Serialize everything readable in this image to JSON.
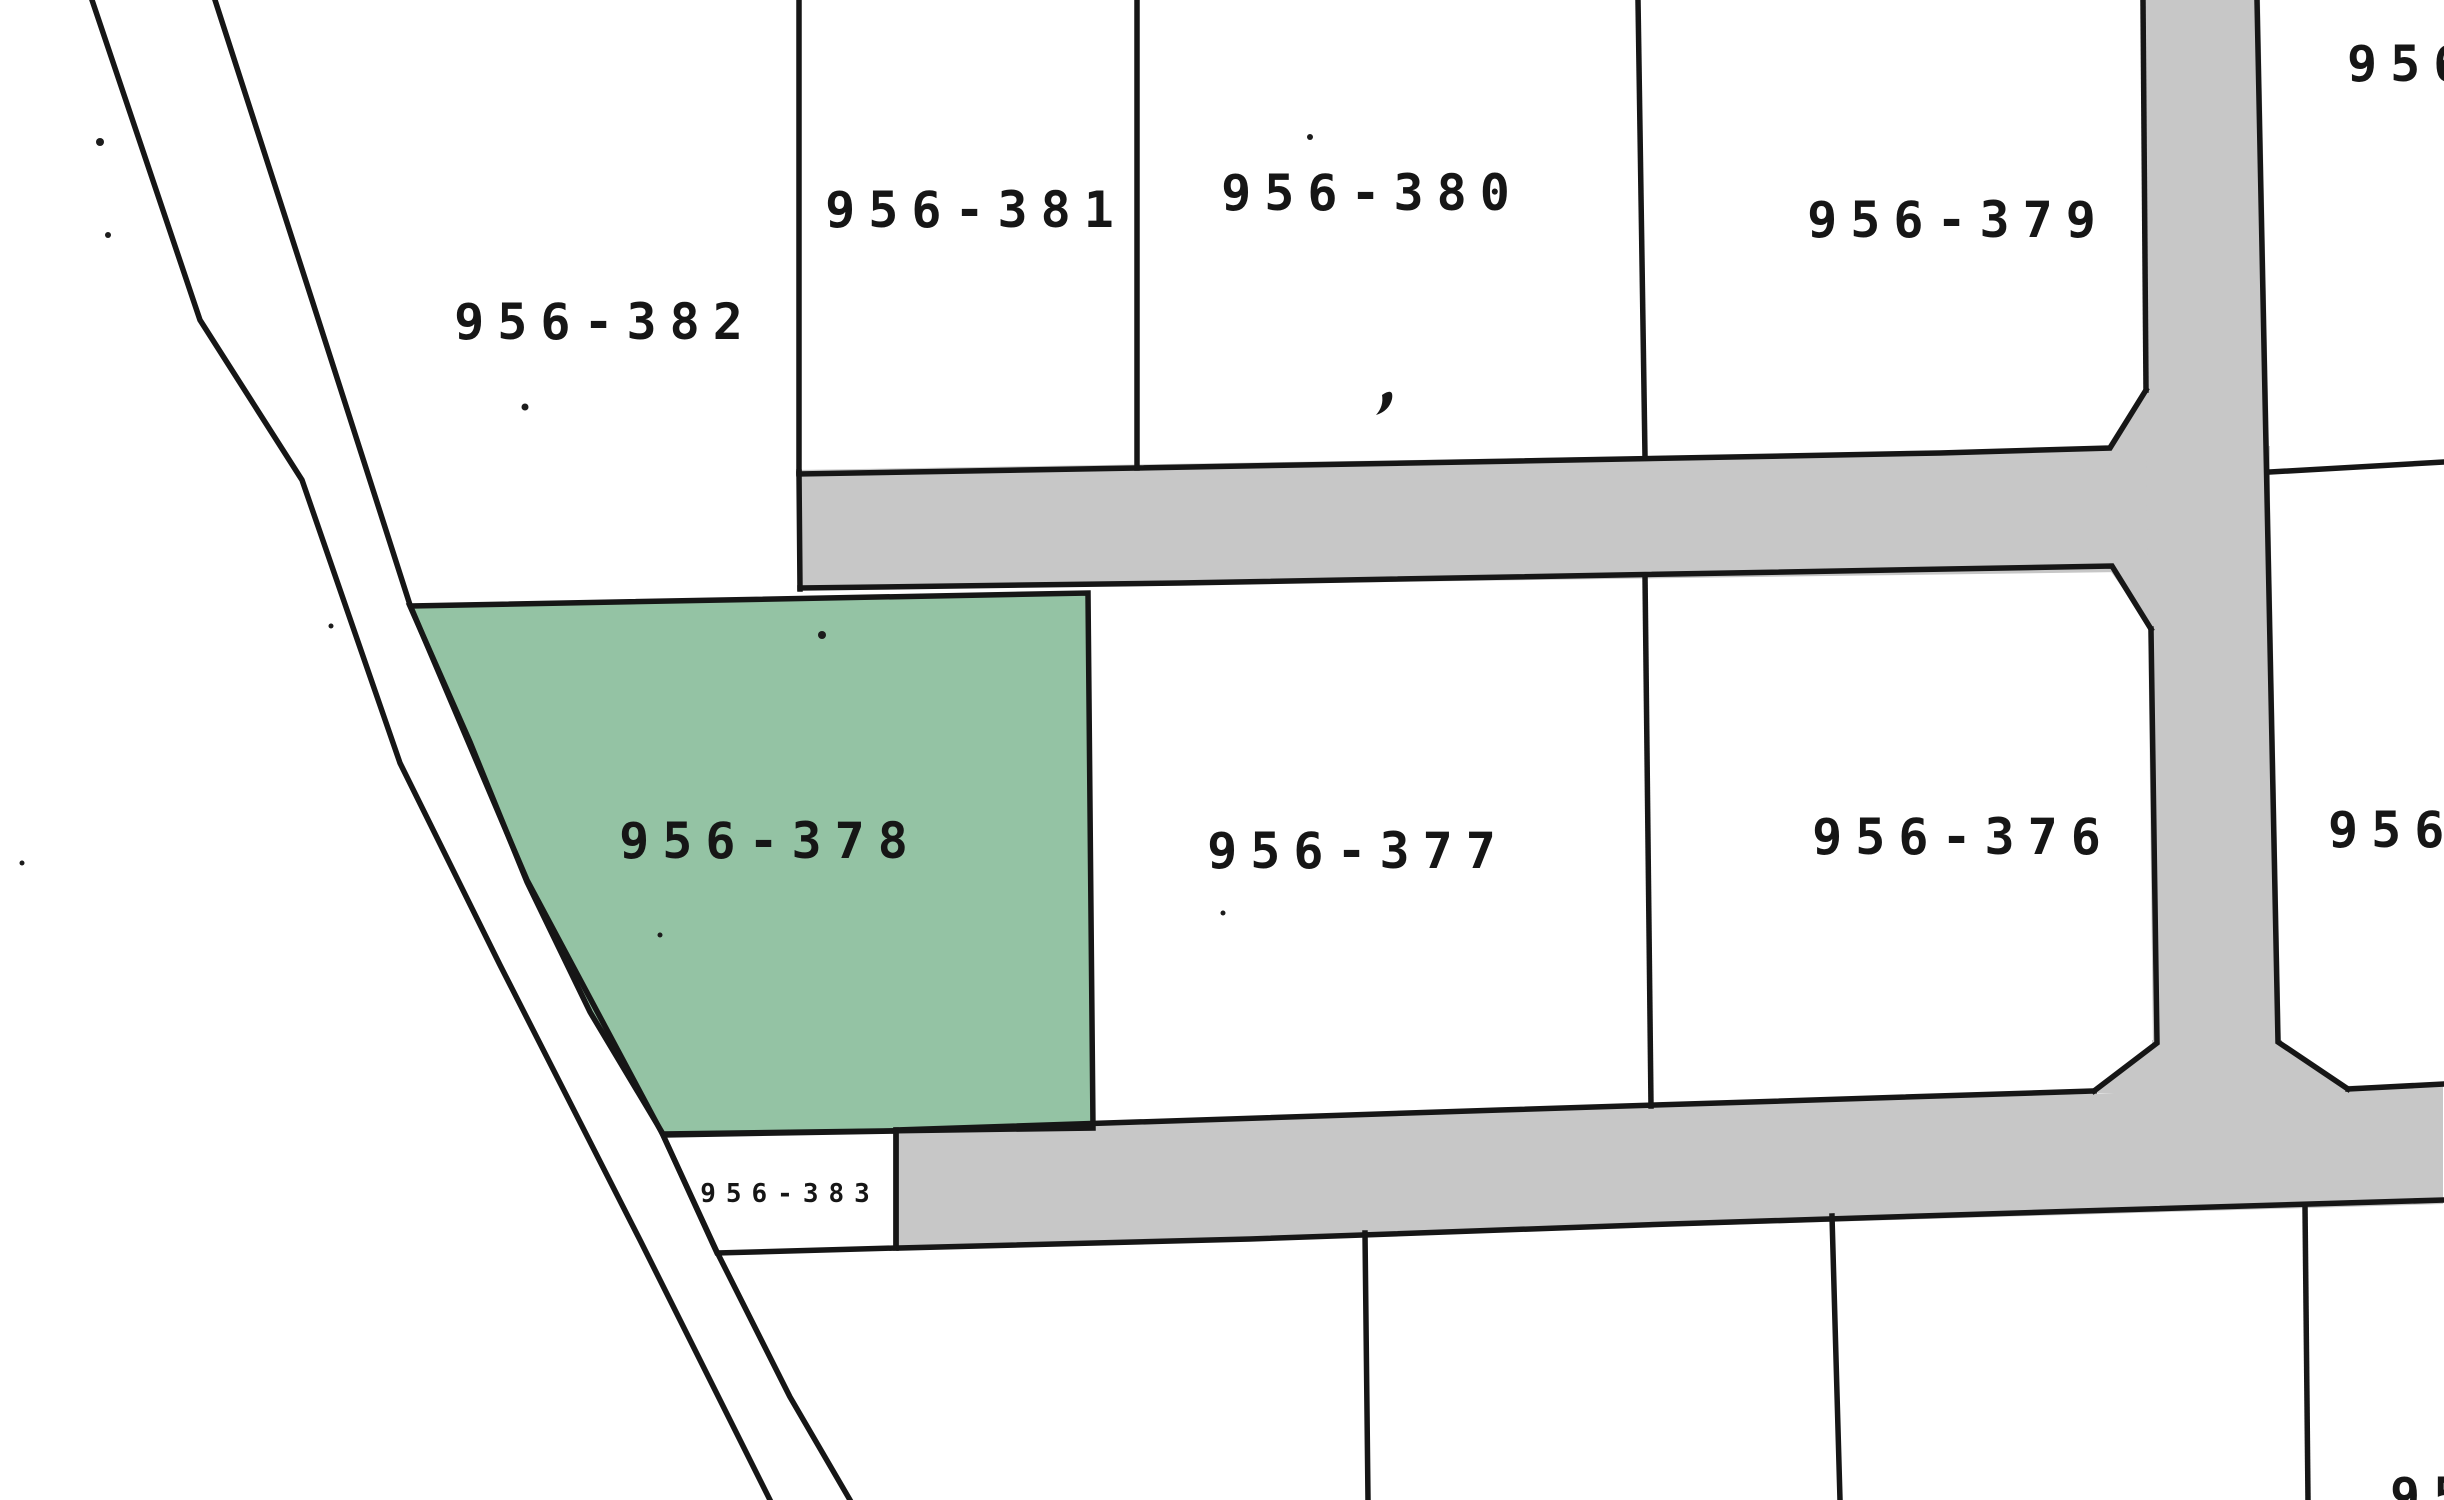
{
  "map": {
    "type": "cadastral-parcel-map",
    "colors": {
      "background": "#ffffff",
      "road": "#c7c7c7",
      "boundary_line": "#161616",
      "label_text": "#161616",
      "highlight": "#94c3a4"
    },
    "highlighted_parcel": "956-378",
    "labels": {
      "p382": "956-382",
      "p381": "956-381",
      "p380": "956-380",
      "p379": "956-379",
      "p378": "956-378",
      "p377": "956-377",
      "p376": "956-376",
      "p383": "956-383",
      "top_right_partial": "956",
      "right_partial": "956",
      "bottom_right_partial": "95"
    }
  }
}
